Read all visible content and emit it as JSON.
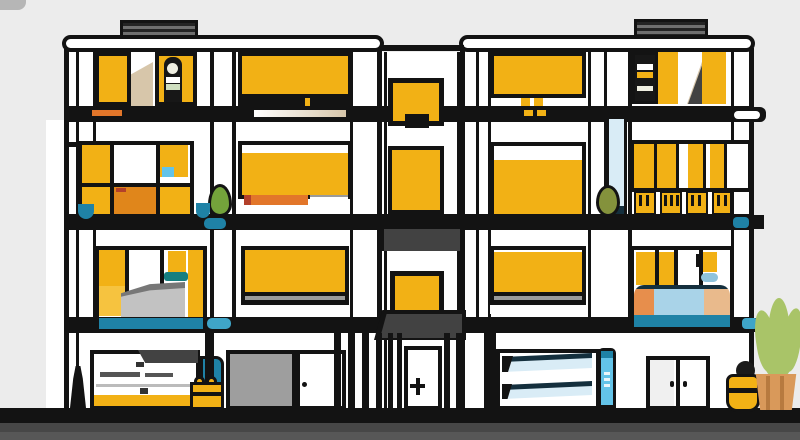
{
  "meta": {
    "kind": "flat vector illustration",
    "subject": "modern three-story apartment building facade, Mondrian-style grid of amber windows, black frames and white walls, street level with garages and shop, plants at right"
  },
  "palette": {
    "bg": "#ECECEC",
    "ink": "#131313",
    "wall": "#FFFFFF",
    "amber": "#F2B115",
    "amberLight": "#F6C33F",
    "orangeBox": "#E0861B",
    "orangeStripe": "#E2762A",
    "redTip": "#B3402A",
    "beige": "#D7C6AA",
    "grayDark": "#424242",
    "grayMid": "#9E9E9E",
    "grayLight": "#C2C2C2",
    "graySoft": "#777777",
    "teal": "#1F82A6",
    "tealDark": "#157F80",
    "tealLight": "#3FA5C8",
    "skyBlue": "#63C3E8",
    "paleBlue": "#D9ECF6",
    "navy": "#142F3D",
    "leafGreen": "#74A33B",
    "oliveGreen": "#84923C",
    "plantGreen": "#A9C468",
    "potTan": "#D9995A",
    "potTanDark": "#B77A3F",
    "bedOrange": "#E78E4C",
    "bedBlue": "#A9D3E8",
    "bedPeach": "#E9BA8C",
    "cream": "#EFEFE2",
    "paleGreen": "#CFDFC0",
    "groundMid": "#474747",
    "groundLight": "#575757"
  },
  "scene": {
    "sky": "plain light gray backdrop",
    "roof": [
      "left roof vent grille",
      "right roof vent grille",
      "white parapet left wing",
      "white parapet right wing"
    ],
    "floors": [
      "top floor",
      "middle floor",
      "lower floor",
      "street level"
    ],
    "windows": "amber glass panels in black frames",
    "center_bay": [
      "stacked amber windows",
      "dark canopy awning",
      "entrance door with cross handle"
    ],
    "street_level": [
      "shop kiosk counter",
      "roller garage door",
      "side service door",
      "louvered blue garage door",
      "double entry doors"
    ],
    "props": [
      "hydrant silhouette",
      "teal bin",
      "yellow fruit crate",
      "green potted sapling",
      "olive potted plant",
      "yellow storage jar with black lid",
      "potted succulent in clay pot"
    ],
    "ground": "dark asphalt strip with black curb line"
  }
}
